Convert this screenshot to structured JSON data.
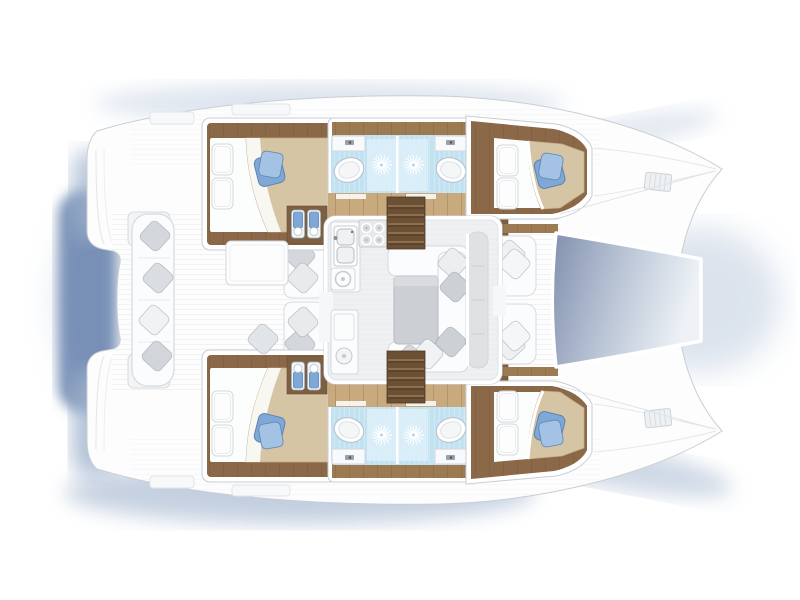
{
  "meta": {
    "title": "Catamaran yacht floor plan",
    "vessel_type": "sailing catamaran, 4-cabin / 4-head layout",
    "view": "top-down deck plan",
    "orientation": "bow pointing right",
    "text_on_image": "none"
  },
  "palette": {
    "pageBg": "#ffffff",
    "hullFill": "#fdfdfe",
    "hullStroke": "#c9ced3",
    "wood": "#8a6848",
    "woodDark": "#7d5f41",
    "woodMid": "#9c7a52",
    "woodLight": "#c9a97e",
    "stairWood": "#6b5036",
    "bathBlue": "#c2e2f1",
    "bathBlueDark": "#a6d4ea",
    "bathBright": "#dbeff9",
    "accentBlue": "#7fa8d6",
    "accentBlueDark": "#5d84b4",
    "accentBlueLight": "#a3c2e4",
    "tan": "#d6c5a4",
    "tanDark": "#c0ab85",
    "furnWhite": "#fbfcfd",
    "grayStroke": "#d6dade",
    "grayPillow": "#d4d8dc",
    "tableGray": "#ccd0d4",
    "salonFloor": "#eef0f2",
    "consoleGray": "#dfe2e5",
    "trampDark": "#8290ae",
    "trampMid": "#b4c0d2",
    "trampLight": "#eef2f7",
    "shadowDeep": "#5f7aa8",
    "shadowMid": "#9fb2cd",
    "shadowSoft": "#c5d1e2"
  },
  "features": {
    "hulls": [
      {
        "side": "port (top)",
        "rooms": [
          "stern platform with helm seat",
          "aft double cabin",
          "two back-to-back bathrooms with shower, washbasin and toilet",
          "forward double cabin",
          "bow deck with hatch"
        ]
      },
      {
        "side": "starboard (bottom)",
        "rooms": [
          "mirror image of port hull"
        ]
      }
    ],
    "center": [
      "aft cockpit with curved bench, four cushions and table",
      "two lounge seats beside salon door",
      "salon with U-galley (double sink, 4-burner stove, oven, fridge)",
      "dinette with gray table and L-sofas with scatter cushions",
      "two companionway stairs down to the hulls",
      "forward cockpit with two facing benches",
      "bow trampoline between the hulls"
    ]
  }
}
